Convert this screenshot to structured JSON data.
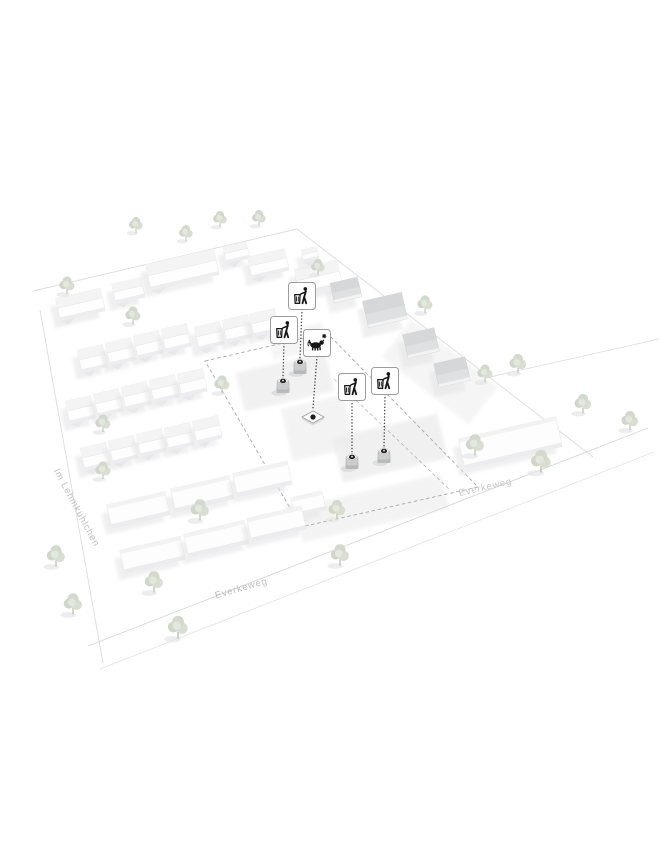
{
  "view": {
    "type": "3d-site-plan-rendering",
    "description": "Axonometric white model of a residential quarter with proposed waste-bin locations marked by pictogram signs and dotted leader lines",
    "background": "#ffffff"
  },
  "plan": {
    "street_labels": [
      {
        "text": "Im Lehmkühlchen"
      },
      {
        "text": "Everkeweg"
      },
      {
        "text": "Everkeweg"
      }
    ],
    "markers": [
      {
        "id": "marker-1",
        "kind": "litter-bin",
        "icon": "litter-disposal-icon",
        "sign": {
          "x": 302,
          "y": 296
        },
        "target": {
          "x": 300,
          "y": 367,
          "type": "bin"
        }
      },
      {
        "id": "marker-2",
        "kind": "litter-bin",
        "icon": "litter-disposal-icon",
        "sign": {
          "x": 284,
          "y": 330
        },
        "target": {
          "x": 283,
          "y": 386,
          "type": "bin"
        }
      },
      {
        "id": "marker-3",
        "kind": "dog-waste-station",
        "icon": "dog-waste-icon",
        "sign": {
          "x": 317,
          "y": 343
        },
        "target": {
          "x": 313,
          "y": 417,
          "type": "ground-plate"
        }
      },
      {
        "id": "marker-4",
        "kind": "litter-bin",
        "icon": "litter-disposal-icon",
        "sign": {
          "x": 352,
          "y": 387
        },
        "target": {
          "x": 352,
          "y": 462,
          "type": "bin"
        }
      },
      {
        "id": "marker-5",
        "kind": "litter-bin",
        "icon": "litter-disposal-icon",
        "sign": {
          "x": 385,
          "y": 381
        },
        "target": {
          "x": 384,
          "y": 456,
          "type": "bin"
        }
      }
    ],
    "colors": {
      "background": "#ffffff",
      "building_white": "#fdfdfd",
      "building_gray": "#dfe0e1",
      "shadow": "#e3e3e3",
      "tree_foliage": "#d3d9cc",
      "dashed_boundary": "#a6aaa9",
      "leader_line": "#3d3d3d",
      "street_line": "#dcdcdc",
      "label_text": "#bdbdbd",
      "sign_border": "#9c9c9c",
      "pictogram": "#161616"
    }
  }
}
